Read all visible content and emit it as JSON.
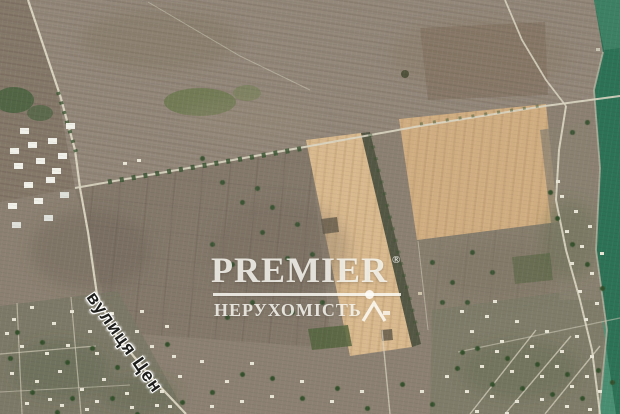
{
  "map": {
    "labels": {
      "street": "вулиця Цен"
    }
  },
  "watermark": {
    "brand": "PREMIER",
    "registered": "®",
    "tagline": "НЕРУХОМІСТЬ",
    "icon_name": "house-roof-icon",
    "text_color": "rgba(253,252,247,0.82)"
  },
  "colors": {
    "terrain_base": "#8b8071",
    "field_top_band": "#93887a",
    "field_tan_left": "#d9b98e",
    "field_tan_right": "#d1ae82",
    "tree_strip": "#4f5440",
    "village_tint": "#7b7867",
    "water_deep": "#2d7156",
    "water_top": "#3f8265",
    "water_shallow": "#4f9377",
    "road": "#dcd6c3",
    "trees": "#35502c",
    "houses": "#e9e5d6"
  }
}
